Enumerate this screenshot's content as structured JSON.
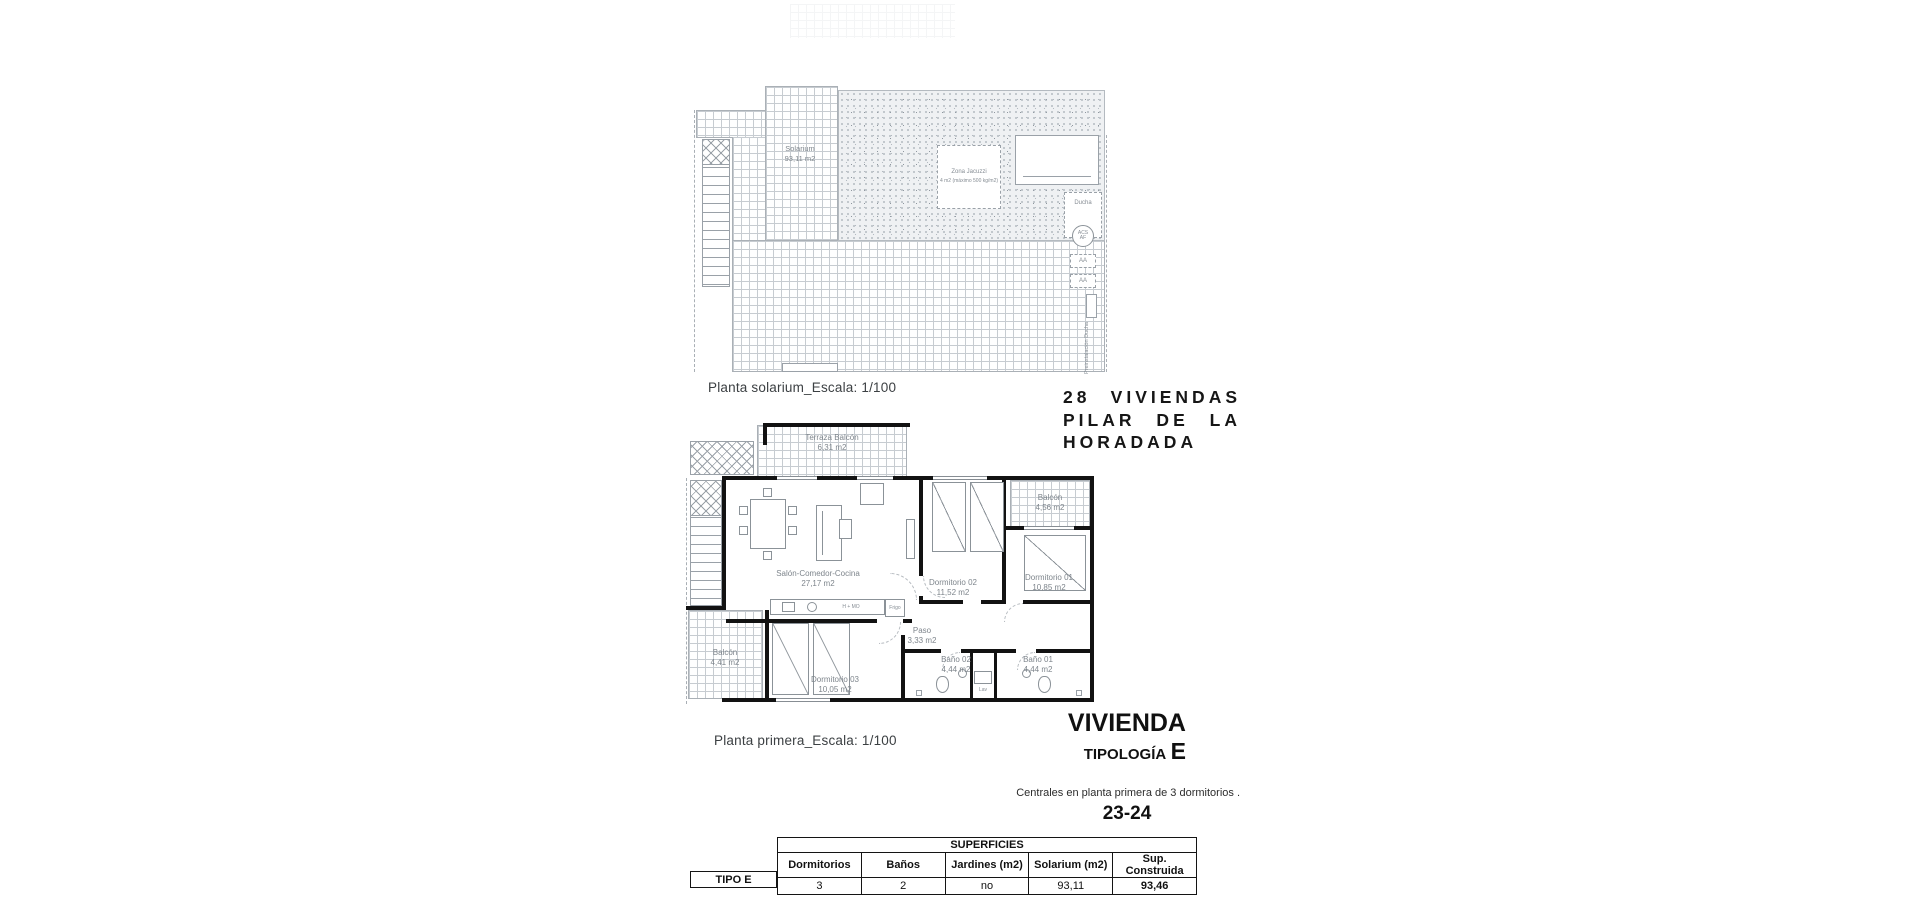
{
  "colors": {
    "wall": "#121212",
    "line": "#9aa1a8",
    "tile_line": "#c7ccd1",
    "stipple_bg": "#eff1f3",
    "muted_text": "#7e858c",
    "dark_text": "#101010"
  },
  "solarium_plan": {
    "caption": "Planta solarium_Escala: 1/100",
    "room_label": {
      "name": "Solarium",
      "area": "93,11 m2"
    },
    "jacuzzi": {
      "name": "Zona Jacuzzi",
      "spec": "4 m2 (máximo 500 kg/m2)"
    },
    "annotations": {
      "ducha": "Ducha",
      "acs": "ACS",
      "af": "AF",
      "aa_1": "AA",
      "aa_2": "AA",
      "preinstalacion": "Preinstalación Ducha"
    }
  },
  "project_title": {
    "line1": "28 VIVIENDAS",
    "line2": "PILAR DE LA",
    "line3": "HORADADA"
  },
  "floor_plan": {
    "caption": "Planta primera_Escala: 1/100",
    "rooms": {
      "terraza": {
        "name": "Terraza Balcón",
        "area": "6,31 m2"
      },
      "salon": {
        "name": "Salón-Comedor-Cocina",
        "area": "27,17 m2"
      },
      "dormitorio02": {
        "name": "Dormitorio 02",
        "area": "11,52 m2"
      },
      "balcon_tr": {
        "name": "Balcón",
        "area": "4,56 m2"
      },
      "dormitorio01": {
        "name": "Dormitorio 01",
        "area": "10,85 m2"
      },
      "paso": {
        "name": "Paso",
        "area": "3,33 m2"
      },
      "bano02": {
        "name": "Baño 02",
        "area": "4,44 m2"
      },
      "bano01": {
        "name": "Baño 01",
        "area": "4,44 m2"
      },
      "dormitorio03": {
        "name": "Dormitorio 03",
        "area": "10,05 m2"
      },
      "balcon_bl": {
        "name": "Balcón",
        "area": "4,41 m2"
      }
    },
    "kitchen": {
      "hob_label": "H + MO",
      "fridge_label": "Frigo",
      "sink_label": "Lav"
    }
  },
  "unit_title": {
    "heading": "VIVIENDA",
    "type_label": "TIPOLOGÍA",
    "type_letter": "E",
    "description": "Centrales en planta primera de 3 dormitorios .",
    "unit_numbers": "23-24"
  },
  "surfaces_table": {
    "row_label": "TIPO E",
    "group_header": "SUPERFICIES",
    "columns": [
      "Dormitorios",
      "Baños",
      "Jardines (m2)",
      "Solarium (m2)",
      "Sup. Construida"
    ],
    "values": [
      "3",
      "2",
      "no",
      "93,11",
      "93,46"
    ]
  }
}
